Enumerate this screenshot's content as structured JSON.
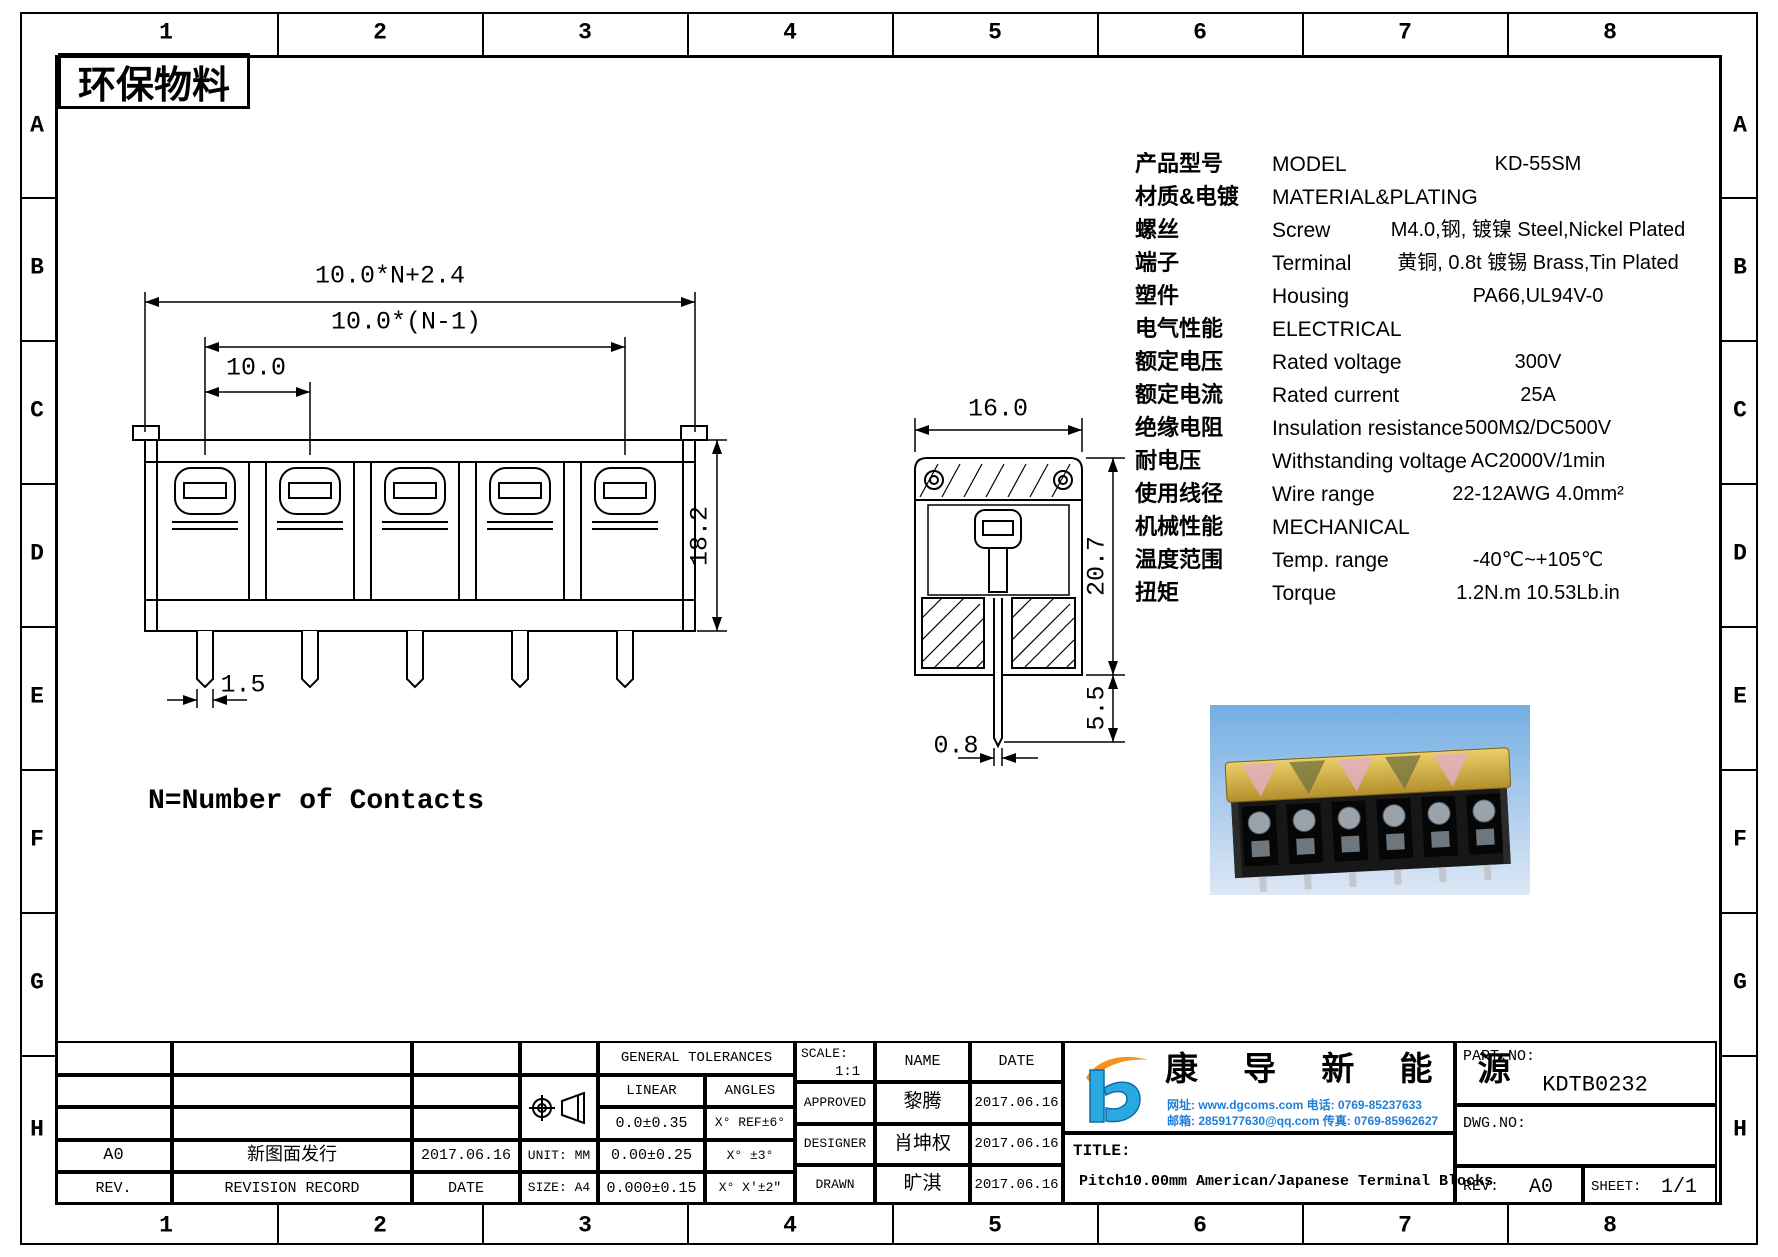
{
  "frame": {
    "cols": [
      "1",
      "2",
      "3",
      "4",
      "5",
      "6",
      "7",
      "8"
    ],
    "rows": [
      "A",
      "B",
      "C",
      "D",
      "E",
      "F",
      "G",
      "H"
    ]
  },
  "eco_label": "环保物料",
  "drawing": {
    "front": {
      "dim_overall": "10.0*N+2.4",
      "dim_span": "10.0*(N-1)",
      "dim_pitch": "10.0",
      "dim_height": "18.2",
      "dim_pin_width": "1.5",
      "note": "N=Number of Contacts"
    },
    "side": {
      "dim_width": "16.0",
      "dim_height": "20.7",
      "dim_pin_length": "5.5",
      "dim_pin_thickness": "0.8"
    }
  },
  "specs": {
    "rows": [
      {
        "cn": "产品型号",
        "en": "MODEL",
        "value": "KD-55SM"
      },
      {
        "cn": "材质&电镀",
        "en": "MATERIAL&PLATING",
        "value": ""
      },
      {
        "cn": "螺丝",
        "en": "Screw",
        "value": "M4.0,钢, 镀镍 Steel,Nickel Plated"
      },
      {
        "cn": "端子",
        "en": "Terminal",
        "value": "黄铜, 0.8t 镀锡 Brass,Tin Plated"
      },
      {
        "cn": "塑件",
        "en": "Housing",
        "value": "PA66,UL94V-0"
      },
      {
        "cn": "电气性能",
        "en": "ELECTRICAL",
        "value": ""
      },
      {
        "cn": "额定电压",
        "en": "Rated voltage",
        "value": "300V"
      },
      {
        "cn": "额定电流",
        "en": "Rated current",
        "value": "25A"
      },
      {
        "cn": "绝缘电阻",
        "en": "Insulation resistance",
        "value": "500MΩ/DC500V"
      },
      {
        "cn": "耐电压",
        "en": "Withstanding voltage",
        "value": "AC2000V/1min"
      },
      {
        "cn": "使用线径",
        "en": "Wire range",
        "value": "22-12AWG 4.0mm²"
      },
      {
        "cn": "机械性能",
        "en": "MECHANICAL",
        "value": ""
      },
      {
        "cn": "温度范围",
        "en": "Temp. range",
        "value": "-40℃~+105℃"
      },
      {
        "cn": "扭矩",
        "en": "Torque",
        "value": "1.2N.m 10.53Lb.in"
      }
    ]
  },
  "title_block": {
    "revision": {
      "rev": "A0",
      "record": "新图面发行",
      "date": "2017.06.16"
    },
    "revision_header": {
      "rev": "REV.",
      "record": "REVISION RECORD",
      "date": "DATE"
    },
    "unit": "UNIT: MM",
    "size": "SIZE: A4",
    "tolerances": {
      "title": "GENERAL TOLERANCES",
      "linear": "LINEAR",
      "angles": "ANGLES",
      "rows": [
        {
          "linear": "0.0±0.35",
          "angle": "X° REF±6°"
        },
        {
          "linear": "0.00±0.25",
          "angle": "X° ±3°"
        },
        {
          "linear": "0.000±0.15",
          "angle": "X° X'±2\""
        }
      ]
    },
    "approvals": {
      "scale_label": "SCALE:",
      "scale": "1:1",
      "name": "NAME",
      "date": "DATE",
      "rows": [
        {
          "role": "APPROVED",
          "name": "黎腾",
          "date": "2017.06.16"
        },
        {
          "role": "DESIGNER",
          "name": "肖坤权",
          "date": "2017.06.16"
        },
        {
          "role": "DRAWN",
          "name": "旷淇",
          "date": "2017.06.16"
        }
      ]
    },
    "company": {
      "name": "康 导 新 能 源",
      "contact_line1": "网址: www.dgcoms.com    电话: 0769-85237633",
      "contact_line2": "邮箱: 2859177630@qq.com  传真: 0769-85962627"
    },
    "part_no_label": "PART.NO:",
    "part_no": "KDTB0232",
    "dwg_no_label": "DWG.NO:",
    "title_label": "TITLE:",
    "title": "Pitch10.00mm American/Japanese Terminal Blocks",
    "rev_label": "REV:",
    "rev": "A0",
    "sheet_label": "SHEET:",
    "sheet": "1/1"
  },
  "colors": {
    "line": "#000000",
    "logo_blue": "#2aa9e1",
    "logo_orange": "#f6921e",
    "contact_blue": "#1f7fd8",
    "photo_cover": "#d4af3d",
    "photo_sky": "#7ab2e4"
  }
}
